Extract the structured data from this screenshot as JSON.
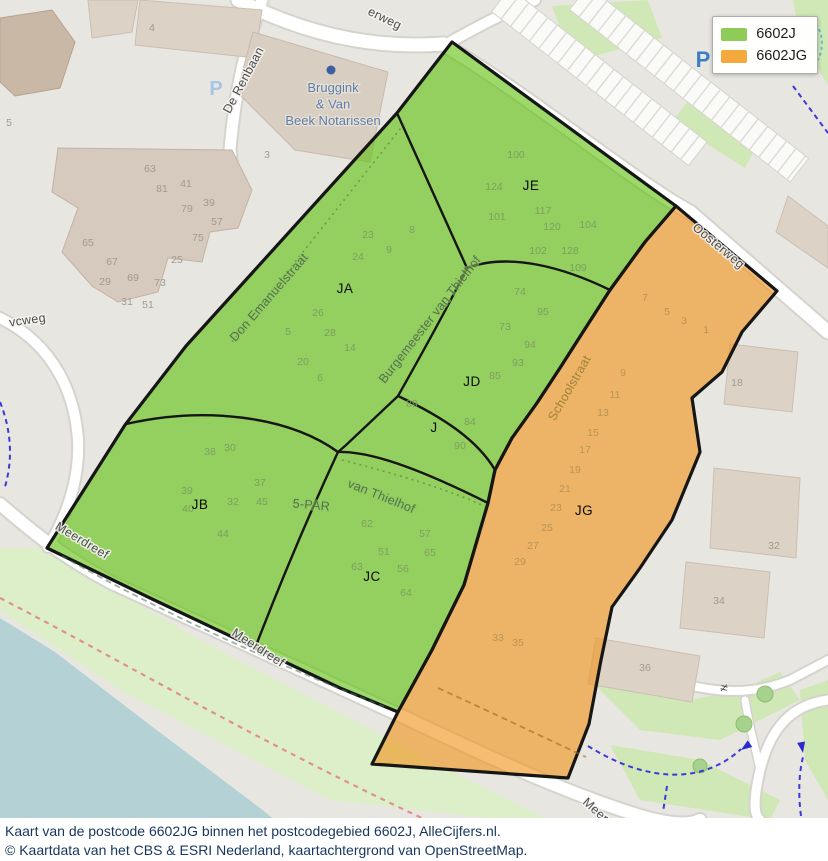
{
  "legend": {
    "items": [
      {
        "label": "6602J",
        "color": "#8ecb57"
      },
      {
        "label": "6602JG",
        "color": "#f3a93c"
      }
    ]
  },
  "caption": {
    "line1": "Kaart van de postcode 6602JG binnen het postcodegebied 6602J, AlleCijfers.nl.",
    "line2": "© Kaartdata van het CBS & ESRI Nederland, kaartachtergrond van OpenStreetMap."
  },
  "map": {
    "region_labels": [
      {
        "text": "JE",
        "x": 531,
        "y": 190
      },
      {
        "text": "JA",
        "x": 345,
        "y": 293
      },
      {
        "text": "JD",
        "x": 472,
        "y": 386
      },
      {
        "text": "J",
        "x": 434,
        "y": 432
      },
      {
        "text": "JB",
        "x": 200,
        "y": 509
      },
      {
        "text": "JC",
        "x": 372,
        "y": 581
      },
      {
        "text": "JG",
        "x": 584,
        "y": 515
      }
    ],
    "street_labels": [
      {
        "text": "De Renbaan",
        "x": 247,
        "y": 82,
        "rot": -62,
        "tint": "plain"
      },
      {
        "text": "erweg",
        "x": 383,
        "y": 22,
        "rot": 26,
        "tint": "plain"
      },
      {
        "text": "vcweg",
        "x": 28,
        "y": 324,
        "rot": -8,
        "tint": "plain"
      },
      {
        "text": "Don Emanuelstraat",
        "x": 272,
        "y": 300,
        "rot": -49,
        "tint": "green"
      },
      {
        "text": "Burgemeester van Thielhof",
        "x": 433,
        "y": 322,
        "rot": -52,
        "tint": "green"
      },
      {
        "text": "van Thielhof",
        "x": 380,
        "y": 500,
        "rot": 22,
        "tint": "green"
      },
      {
        "text": "5-PAR",
        "x": 311,
        "y": 509,
        "rot": 5,
        "tint": "green"
      },
      {
        "text": "Schoolstraat",
        "x": 573,
        "y": 390,
        "rot": -60,
        "tint": "orange"
      },
      {
        "text": "Oosterweg",
        "x": 716,
        "y": 249,
        "rot": 40,
        "tint": "plain"
      },
      {
        "text": "Meerdreef",
        "x": 80,
        "y": 544,
        "rot": 31,
        "tint": "plain"
      },
      {
        "text": "Meerdreef",
        "x": 256,
        "y": 651,
        "rot": 33,
        "tint": "plain"
      },
      {
        "text": "Meer",
        "x": 593,
        "y": 813,
        "rot": 42,
        "tint": "plain"
      }
    ],
    "poi_labels": [
      {
        "lines": [
          "Bruggink",
          "& Van",
          "Beek Notarissen"
        ],
        "x": 333,
        "y": 92,
        "dy": 16.5
      }
    ],
    "parking_icons": [
      {
        "x": 216,
        "y": 95,
        "color": "#a5c6e6",
        "size": 20
      },
      {
        "x": 703,
        "y": 67,
        "color": "#3c7ec4",
        "size": 22
      }
    ],
    "misc_symbols": [
      {
        "text": "≠",
        "x": 723,
        "y": 692,
        "rot": 15
      }
    ],
    "house_numbers": [
      {
        "t": "100",
        "x": 516,
        "y": 158,
        "c": "g"
      },
      {
        "t": "124",
        "x": 494,
        "y": 190,
        "c": "g"
      },
      {
        "t": "101",
        "x": 497,
        "y": 220,
        "c": "g"
      },
      {
        "t": "117",
        "x": 543,
        "y": 214,
        "c": "g"
      },
      {
        "t": "120",
        "x": 552,
        "y": 230,
        "c": "g"
      },
      {
        "t": "104",
        "x": 588,
        "y": 228,
        "c": "g"
      },
      {
        "t": "102",
        "x": 538,
        "y": 254,
        "c": "g"
      },
      {
        "t": "128",
        "x": 570,
        "y": 254,
        "c": "g"
      },
      {
        "t": "109",
        "x": 578,
        "y": 271,
        "c": "g"
      },
      {
        "t": "23",
        "x": 368,
        "y": 238,
        "c": "g"
      },
      {
        "t": "8",
        "x": 412,
        "y": 233,
        "c": "g"
      },
      {
        "t": "24",
        "x": 358,
        "y": 260,
        "c": "g"
      },
      {
        "t": "9",
        "x": 389,
        "y": 253,
        "c": "g"
      },
      {
        "t": "26",
        "x": 318,
        "y": 316,
        "c": "g"
      },
      {
        "t": "5",
        "x": 288,
        "y": 335,
        "c": "g"
      },
      {
        "t": "28",
        "x": 330,
        "y": 336,
        "c": "g"
      },
      {
        "t": "14",
        "x": 350,
        "y": 351,
        "c": "g"
      },
      {
        "t": "20",
        "x": 303,
        "y": 365,
        "c": "g"
      },
      {
        "t": "6",
        "x": 320,
        "y": 381,
        "c": "g"
      },
      {
        "t": "74",
        "x": 520,
        "y": 295,
        "c": "g"
      },
      {
        "t": "95",
        "x": 543,
        "y": 315,
        "c": "g"
      },
      {
        "t": "73",
        "x": 505,
        "y": 330,
        "c": "g"
      },
      {
        "t": "94",
        "x": 530,
        "y": 348,
        "c": "g"
      },
      {
        "t": "93",
        "x": 518,
        "y": 366,
        "c": "g"
      },
      {
        "t": "85",
        "x": 495,
        "y": 379,
        "c": "g"
      },
      {
        "t": "89",
        "x": 412,
        "y": 407,
        "c": "g"
      },
      {
        "t": "84",
        "x": 470,
        "y": 425,
        "c": "g"
      },
      {
        "t": "90",
        "x": 460,
        "y": 449,
        "c": "g"
      },
      {
        "t": "38",
        "x": 210,
        "y": 455,
        "c": "g"
      },
      {
        "t": "30",
        "x": 230,
        "y": 451,
        "c": "g"
      },
      {
        "t": "39",
        "x": 187,
        "y": 494,
        "c": "g"
      },
      {
        "t": "37",
        "x": 260,
        "y": 486,
        "c": "g"
      },
      {
        "t": "32",
        "x": 233,
        "y": 505,
        "c": "g"
      },
      {
        "t": "45",
        "x": 262,
        "y": 505,
        "c": "g"
      },
      {
        "t": "40",
        "x": 188,
        "y": 512,
        "c": "g"
      },
      {
        "t": "44",
        "x": 223,
        "y": 537,
        "c": "g"
      },
      {
        "t": "62",
        "x": 367,
        "y": 527,
        "c": "g"
      },
      {
        "t": "57",
        "x": 425,
        "y": 537,
        "c": "g"
      },
      {
        "t": "51",
        "x": 384,
        "y": 555,
        "c": "g"
      },
      {
        "t": "65",
        "x": 430,
        "y": 556,
        "c": "g"
      },
      {
        "t": "63",
        "x": 357,
        "y": 570,
        "c": "g"
      },
      {
        "t": "56",
        "x": 403,
        "y": 572,
        "c": "g"
      },
      {
        "t": "64",
        "x": 406,
        "y": 596,
        "c": "g"
      },
      {
        "t": "7",
        "x": 645,
        "y": 301,
        "c": "o"
      },
      {
        "t": "5",
        "x": 667,
        "y": 315,
        "c": "o"
      },
      {
        "t": "3",
        "x": 684,
        "y": 324,
        "c": "o"
      },
      {
        "t": "1",
        "x": 706,
        "y": 333,
        "c": "o"
      },
      {
        "t": "9",
        "x": 623,
        "y": 376,
        "c": "o"
      },
      {
        "t": "11",
        "x": 615,
        "y": 398,
        "c": "o"
      },
      {
        "t": "13",
        "x": 603,
        "y": 416,
        "c": "o"
      },
      {
        "t": "15",
        "x": 593,
        "y": 436,
        "c": "o"
      },
      {
        "t": "17",
        "x": 585,
        "y": 453,
        "c": "o"
      },
      {
        "t": "19",
        "x": 575,
        "y": 473,
        "c": "o"
      },
      {
        "t": "21",
        "x": 565,
        "y": 492,
        "c": "o"
      },
      {
        "t": "23",
        "x": 556,
        "y": 511,
        "c": "o"
      },
      {
        "t": "25",
        "x": 547,
        "y": 531,
        "c": "o"
      },
      {
        "t": "27",
        "x": 533,
        "y": 549,
        "c": "o"
      },
      {
        "t": "29",
        "x": 520,
        "y": 565,
        "c": "o"
      },
      {
        "t": "33",
        "x": 498,
        "y": 641,
        "c": "o"
      },
      {
        "t": "35",
        "x": 518,
        "y": 646,
        "c": "o"
      },
      {
        "t": "4",
        "x": 152,
        "y": 31,
        "c": "n"
      },
      {
        "t": "5",
        "x": 9,
        "y": 126,
        "c": "n"
      },
      {
        "t": "3",
        "x": 267,
        "y": 158,
        "c": "n"
      },
      {
        "t": "63",
        "x": 150,
        "y": 172,
        "c": "n"
      },
      {
        "t": "81",
        "x": 162,
        "y": 192,
        "c": "n"
      },
      {
        "t": "41",
        "x": 186,
        "y": 187,
        "c": "n"
      },
      {
        "t": "79",
        "x": 187,
        "y": 212,
        "c": "n"
      },
      {
        "t": "39",
        "x": 209,
        "y": 206,
        "c": "n"
      },
      {
        "t": "57",
        "x": 217,
        "y": 225,
        "c": "n"
      },
      {
        "t": "75",
        "x": 198,
        "y": 241,
        "c": "n"
      },
      {
        "t": "65",
        "x": 88,
        "y": 246,
        "c": "n"
      },
      {
        "t": "67",
        "x": 112,
        "y": 265,
        "c": "n"
      },
      {
        "t": "25",
        "x": 177,
        "y": 263,
        "c": "n"
      },
      {
        "t": "29",
        "x": 105,
        "y": 285,
        "c": "n"
      },
      {
        "t": "69",
        "x": 133,
        "y": 281,
        "c": "n"
      },
      {
        "t": "73",
        "x": 160,
        "y": 286,
        "c": "n"
      },
      {
        "t": "31",
        "x": 127,
        "y": 305,
        "c": "n"
      },
      {
        "t": "51",
        "x": 148,
        "y": 308,
        "c": "n"
      },
      {
        "t": "18",
        "x": 737,
        "y": 386,
        "c": "n"
      },
      {
        "t": "32",
        "x": 774,
        "y": 549,
        "c": "n"
      },
      {
        "t": "34",
        "x": 719,
        "y": 604,
        "c": "n"
      },
      {
        "t": "36",
        "x": 645,
        "y": 671,
        "c": "n"
      }
    ]
  },
  "colors": {
    "area_6602j_fill": "#61c10e",
    "area_6602jg_fill": "#f0941c",
    "boundary": "#161616",
    "water": "#b4d2d6",
    "grass": "#cfe8b6",
    "building": "#ddd2c6",
    "caption_text": "#17365f"
  }
}
